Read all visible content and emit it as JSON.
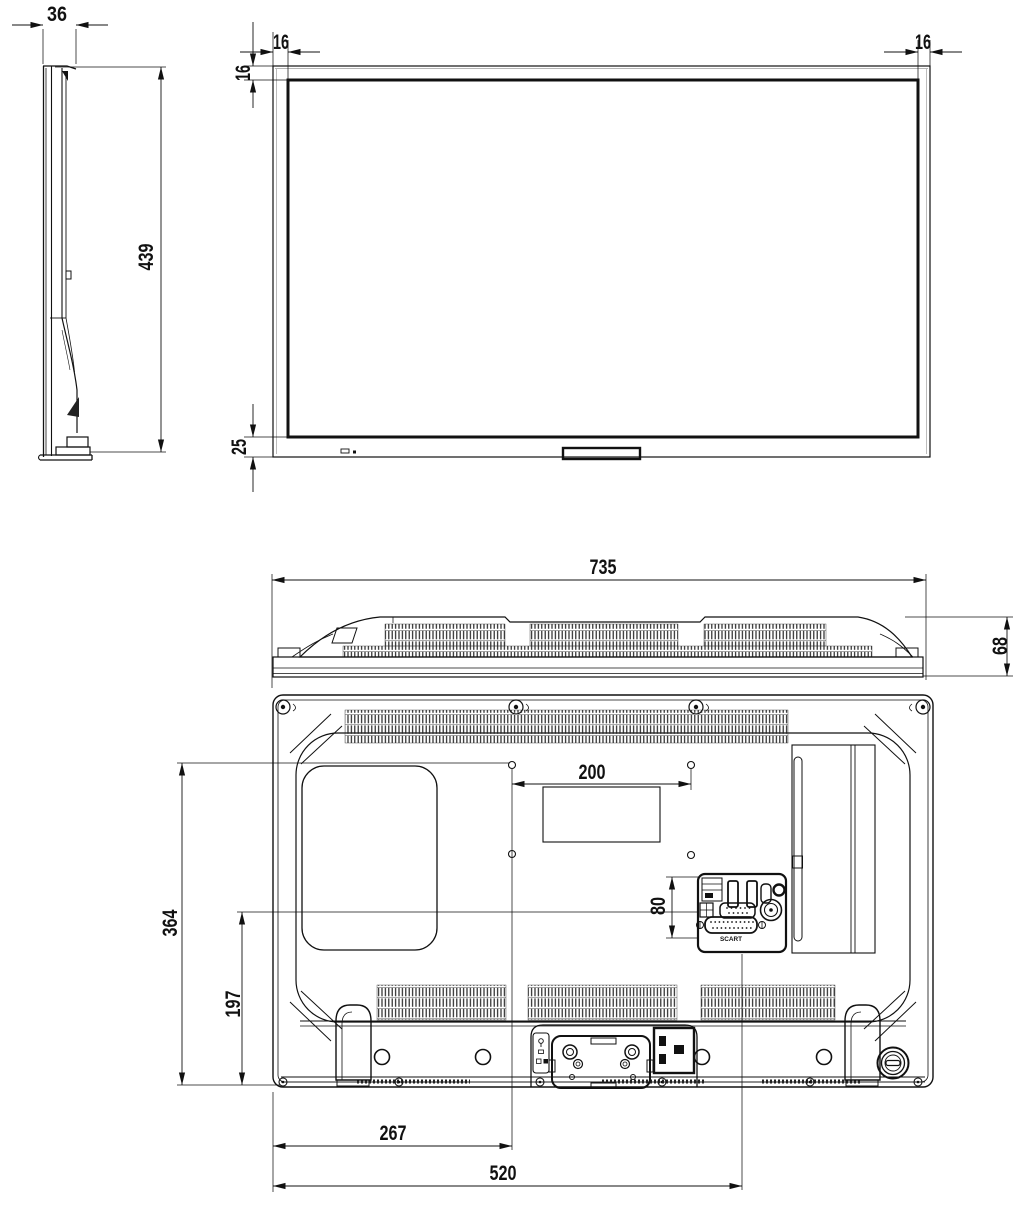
{
  "views": {
    "side": {
      "depth_mm": "36",
      "height_mm": "439"
    },
    "front": {
      "bezel_left_mm": "16",
      "bezel_top_mm": "16",
      "bezel_right_mm": "16",
      "bezel_bottom_mm": "25"
    },
    "top": {
      "width_mm": "735",
      "depth_mm": "68"
    },
    "rear": {
      "vesa_width_mm": "200",
      "io_panel_height_mm": "80",
      "vesa_top_from_bottom_mm": "364",
      "io_from_bottom_mm": "197",
      "vesa_left_from_edge_mm": "267",
      "io_center_from_edge_mm": "520",
      "scart_label": "SCART"
    }
  }
}
